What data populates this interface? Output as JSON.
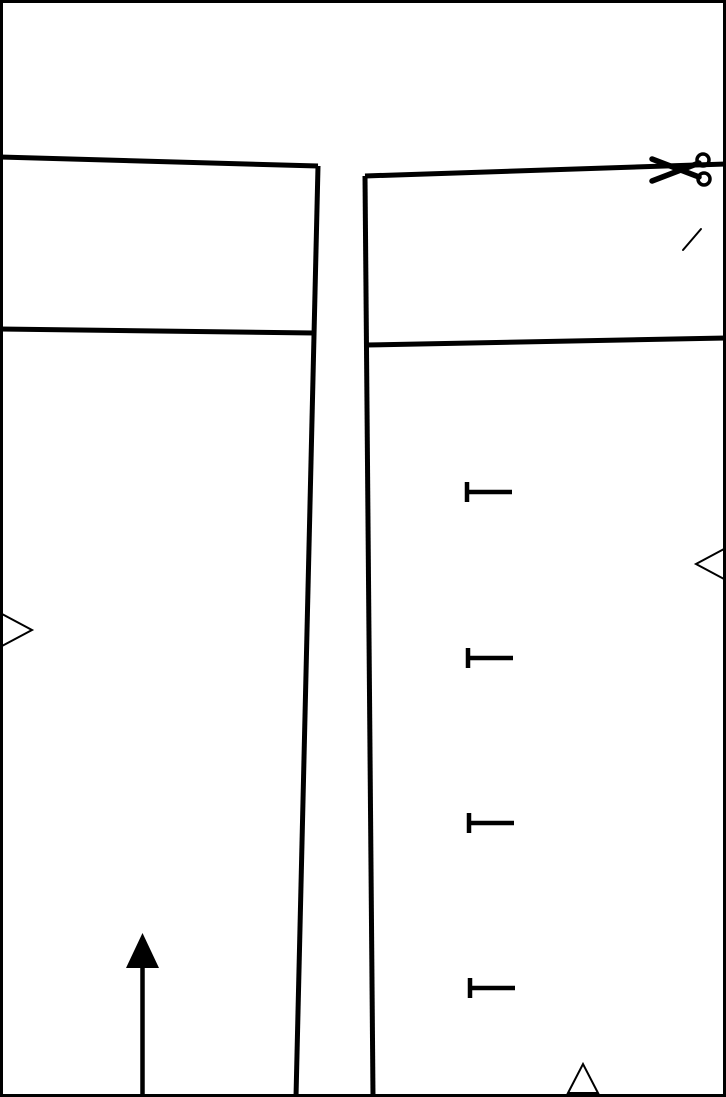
{
  "page": {
    "width": 726,
    "height": 1097,
    "background_color": "#ffffff",
    "line_color": "#000000"
  },
  "icons": {
    "scissors": "✂",
    "pin_mark": "⊢",
    "match_triangle_right": "▷",
    "match_triangle_left": "◁",
    "match_triangle_up": "△",
    "grainline_arrow": "⬆"
  },
  "drawing": {
    "border": {
      "x": 1.5,
      "y": 1.5,
      "width": 723,
      "height": 1094
    },
    "left_piece": {
      "top_edge": "M 0 157 L 318 166",
      "side_edge": "M 318 166 L 296 1097",
      "seam_line": "M 0 329 L 314 333"
    },
    "right_piece": {
      "cut_edge": "M 365 176 L 726 164",
      "side_edge": "M 365 176 L 373 1097",
      "seam_line": "M 366 345 L 726 338"
    },
    "scissors": {
      "transform": "translate(683,170)"
    },
    "slash_mark": "M 683 250 L 701 229",
    "pin_marks": [
      {
        "x": 467,
        "y": 492
      },
      {
        "x": 468,
        "y": 658
      },
      {
        "x": 469,
        "y": 823
      },
      {
        "x": 470,
        "y": 988
      }
    ],
    "pin_mark_geometry": {
      "bar_half_height": 10,
      "arm_length": 45
    },
    "triangles": {
      "left_edge": "2,614 32,630 2,646",
      "right_edge": "724,549 696,564 724,579",
      "bottom_edge": "568,1093 583,1064 598,1093"
    },
    "grainline_arrow": {
      "shaft": "M 142.5 1097 L 142.5 963",
      "head": "142.5,933 126,968 159,968"
    }
  }
}
